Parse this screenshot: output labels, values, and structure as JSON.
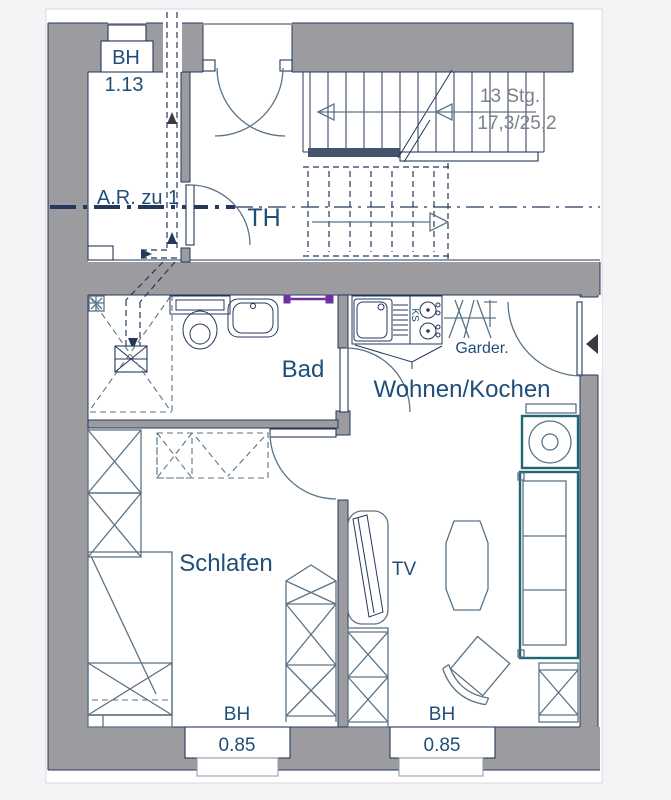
{
  "colors": {
    "page_bg": "#f4f4f6",
    "sheet_border": "#d9d9de",
    "wall_gray": "#9c9ca0",
    "navy": "#24385c",
    "slate": "#5a7386",
    "teal": "#1f6673",
    "label_blue": "#1f4e79",
    "stair_text_gray": "#7f7f84",
    "dark_bar": "#44546a",
    "black_marker": "#3a3a40",
    "purple": "#7030a0"
  },
  "labels": {
    "window_top": {
      "sill": "BH",
      "height": "1.13"
    },
    "stairs": {
      "count": "13 Stg.",
      "dim": "17,3/25,2"
    },
    "storage_room": "A.R. zu 1",
    "stair_hall": "TH",
    "bathroom": "Bad",
    "coat_rack": "Garder.",
    "living_kitchen": "Wohnen/Kochen",
    "bedroom": "Schlafen",
    "tv": "TV",
    "fridge": "KS",
    "window_bottom_left": {
      "sill": "BH",
      "height": "0.85"
    },
    "window_bottom_right": {
      "sill": "BH",
      "height": "0.85"
    }
  }
}
